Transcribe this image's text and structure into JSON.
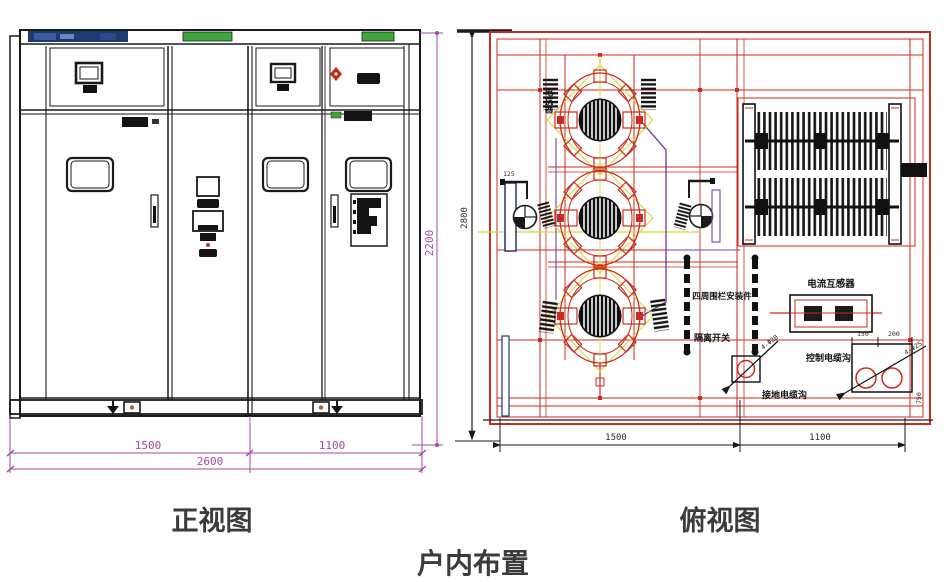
{
  "captions": {
    "front_view": "正视图",
    "top_view": "俯视图",
    "footer": "户内布置"
  },
  "front_view": {
    "dimensions": {
      "left_width": "1500",
      "right_width": "1100",
      "total_width": "2600",
      "height": "2200"
    }
  },
  "top_view": {
    "dimensions": {
      "height": "2800",
      "left_width": "1500",
      "right_width": "1100",
      "fan_offset": "125",
      "hole_spacing_1": "150",
      "hole_spacing_2": "200",
      "edge_offset": "750",
      "bolt_callout_left": "4-Φ20",
      "bolt_callout_right": "4-Φ25"
    },
    "labels": {
      "reactor": "电抗器",
      "fence": "四周围栏安装件",
      "disconnect_switch": "隔离开关",
      "current_transformer": "电流互感器",
      "control_cable_trench": "控制电缆沟",
      "ground_cable_trench": "接地电缆沟"
    }
  },
  "colors": {
    "drawing_black": "#1a1a1a",
    "dimension_magenta": "#a348a3",
    "frame_red": "#cc2a1e",
    "accent_green": "#3fa63a",
    "nameplate_navy": "#1e3a6e",
    "wiring_yellow": "#d8d838",
    "wiring_purple": "#7a3fa8"
  }
}
